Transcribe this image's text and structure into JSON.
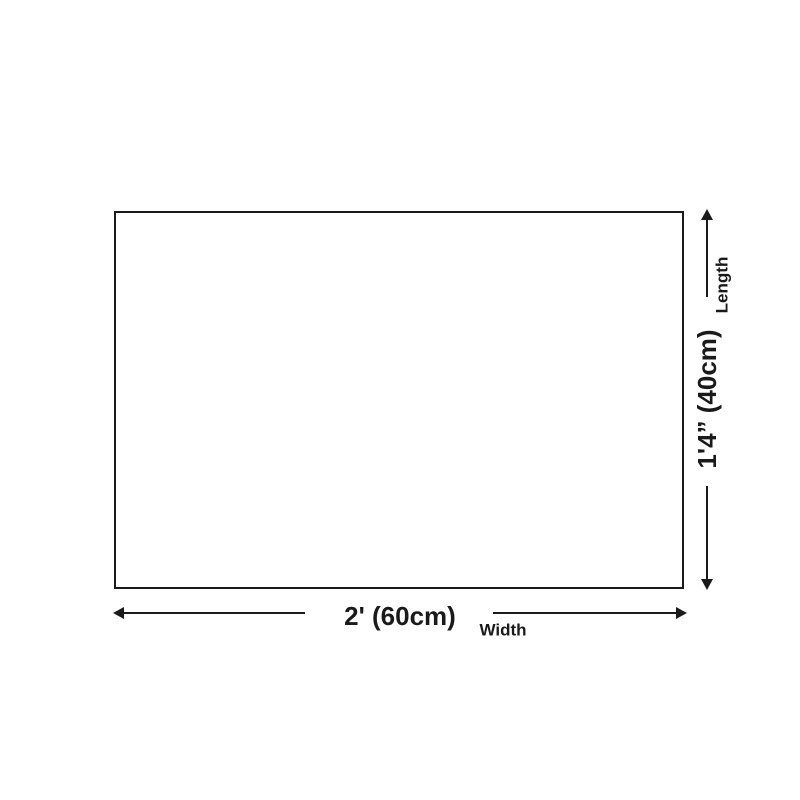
{
  "page": {
    "background_color": "#ffffff",
    "line_color": "#1a1a1a"
  },
  "diagram": {
    "type": "product-size-diagram",
    "width_dimension": {
      "value": "2' (60cm)",
      "axis_label": "Width"
    },
    "length_dimension": {
      "value": "1'4” (40cm)",
      "axis_label": "Length"
    }
  }
}
